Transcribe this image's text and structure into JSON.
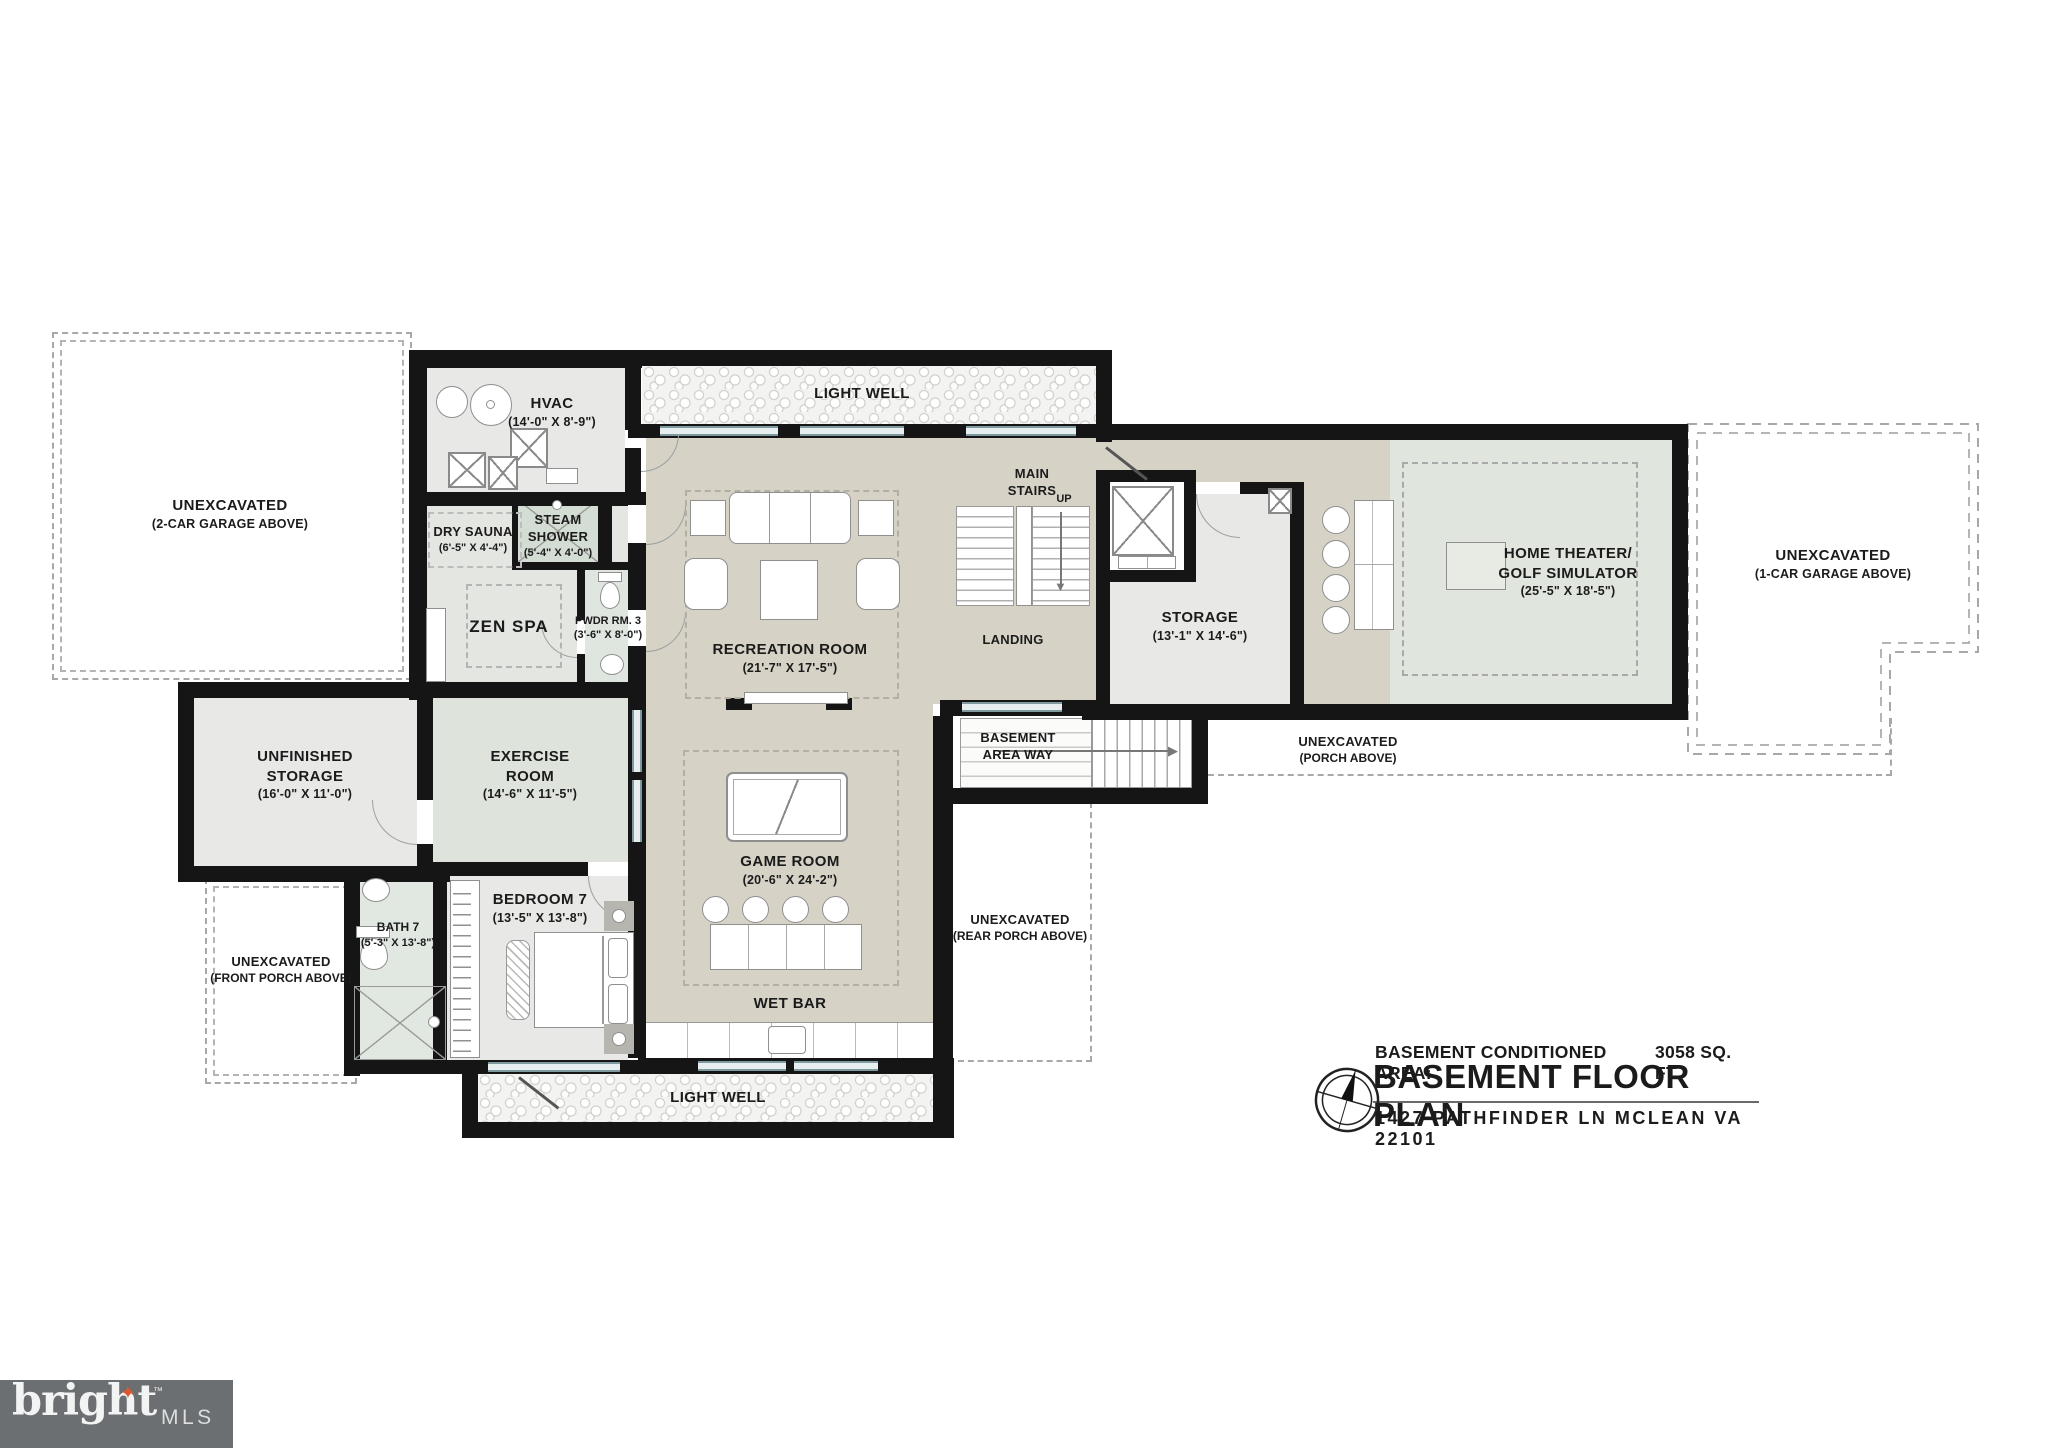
{
  "colors": {
    "wall": "#151515",
    "floor_beige": "#d6d2c6",
    "floor_gray": "#e8e9e7",
    "floor_sage": "#dee3db",
    "window_teal": "#7e9a9e",
    "logo_background": "#6b6f71",
    "logo_star": "#e0572e"
  },
  "rooms": {
    "garage2": {
      "line1": "UNEXCAVATED",
      "line2": "(2-CAR GARAGE ABOVE)"
    },
    "hvac": {
      "name": "HVAC",
      "dims": "(14'-0\" X 8'-9\")"
    },
    "light_well_top": {
      "name": "LIGHT WELL"
    },
    "dry_sauna": {
      "name": "DRY SAUNA",
      "dims": "(6'-5\" X 4'-4\")"
    },
    "steam_shower": {
      "line1": "STEAM",
      "line2": "SHOWER",
      "dims": "(5'-4\" X 4'-0\")"
    },
    "zen_spa": {
      "name": "ZEN SPA"
    },
    "pwdr": {
      "name": "PWDR RM. 3",
      "dims": "(3'-6\" X 8'-0\")"
    },
    "recreation": {
      "name": "RECREATION ROOM",
      "dims": "(21'-7\" X 17'-5\")"
    },
    "main_stairs": {
      "line1": "MAIN",
      "line2": "STAIRS",
      "up": "UP"
    },
    "landing": {
      "name": "LANDING"
    },
    "storage": {
      "name": "STORAGE",
      "dims": "(13'-1\" X 14'-6\")"
    },
    "theater": {
      "line1": "HOME THEATER/",
      "line2": "GOLF SIMULATOR",
      "dims": "(25'-5\" X 18'-5\")"
    },
    "garage1": {
      "line1": "UNEXCAVATED",
      "line2": "(1-CAR GARAGE ABOVE)"
    },
    "porch_mid": {
      "line1": "UNEXCAVATED",
      "line2": "(PORCH ABOVE)"
    },
    "unfinished": {
      "line1": "UNFINISHED",
      "line2": "STORAGE",
      "dims": "(16'-0\" X 11'-0\")"
    },
    "exercise": {
      "line1": "EXERCISE",
      "line2": "ROOM",
      "dims": "(14'-6\" X 11'-5\")"
    },
    "areaway": {
      "line1": "BASEMENT",
      "line2": "AREA WAY"
    },
    "porch_rear": {
      "line1": "UNEXCAVATED",
      "line2": "(REAR PORCH ABOVE)"
    },
    "bath7": {
      "name": "BATH 7",
      "dims": "(5'-3\" X 13'-8\")"
    },
    "bedroom7": {
      "name": "BEDROOM 7",
      "dims": "(13'-5\" X 13'-8\")"
    },
    "porch_front": {
      "line1": "UNEXCAVATED",
      "line2": "(FRONT PORCH ABOVE)"
    },
    "game": {
      "name": "GAME ROOM",
      "dims": "(20'-6\" X 24'-2\")"
    },
    "wet_bar": {
      "name": "WET BAR"
    },
    "light_well_bottom": {
      "name": "LIGHT WELL"
    }
  },
  "title_block": {
    "conditioned_label": "BASEMENT CONDITIONED AREA:",
    "conditioned_value": "3058 SQ. FT.",
    "title": "BASEMENT FLOOR PLAN",
    "address": "1427 PATHFINDER LN MCLEAN VA 22101"
  },
  "footer_logo": {
    "brand": "bright",
    "tm": "™",
    "suffix": "MLS"
  },
  "icons": {
    "arrow_down": "▼",
    "arrow_right": "▶",
    "star": "✦"
  }
}
